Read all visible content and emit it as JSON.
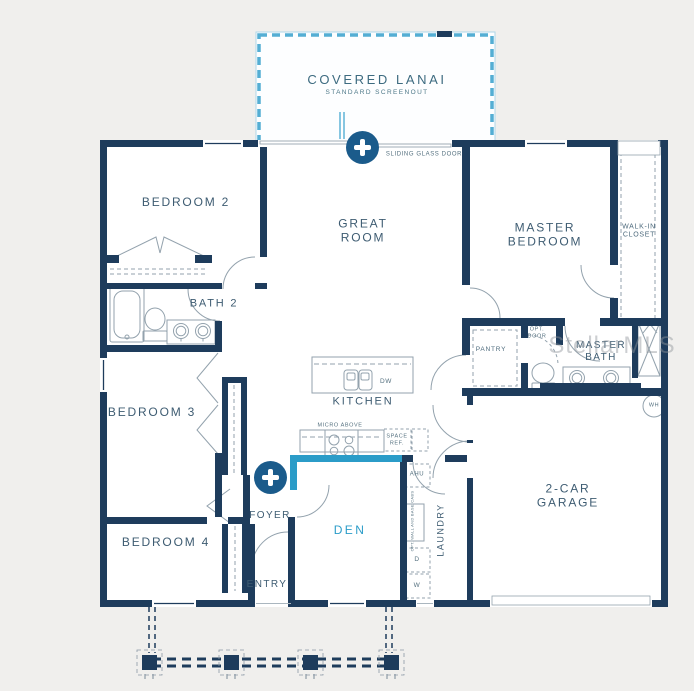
{
  "watermark": "StellarMLS",
  "colors": {
    "wall_navy": "#1e3c5c",
    "accent_teal": "#2b9cc8",
    "hotspot_blue": "#1b5b8b",
    "lanai_dash": "#54aed4",
    "background": "#f0efed",
    "fixture_gray": "#93a2ad"
  },
  "labels": {
    "covered_lanai": "COVERED LANAI",
    "standard_screenout": "STANDARD SCREENOUT",
    "sliding_glass_door": "SLIDING GLASS DOOR",
    "bedroom2": "BEDROOM 2",
    "great_room": "GREAT ROOM",
    "master_bedroom": "MASTER BEDROOM",
    "walk_in_closet": "WALK-IN CLOSET",
    "bath2": "BATH 2",
    "bedroom3": "BEDROOM 3",
    "bedroom4": "BEDROOM 4",
    "kitchen": "KITCHEN",
    "dw": "DW",
    "micro_above": "MICRO ABOVE",
    "space_ref": "SPACE REF.",
    "ahu": "AHU",
    "pantry": "PANTRY",
    "opt_door": "OPT. DOOR",
    "master_bath": "MASTER BATH",
    "wh": "WH",
    "foyer": "FOYER",
    "den": "DEN",
    "entry": "ENTRY",
    "laundry": "LAUNDRY",
    "opt_wall_cabs": "OPT. WALL AND BASE CABS",
    "dryer": "D",
    "washer": "W",
    "garage": "2-CAR GARAGE"
  }
}
